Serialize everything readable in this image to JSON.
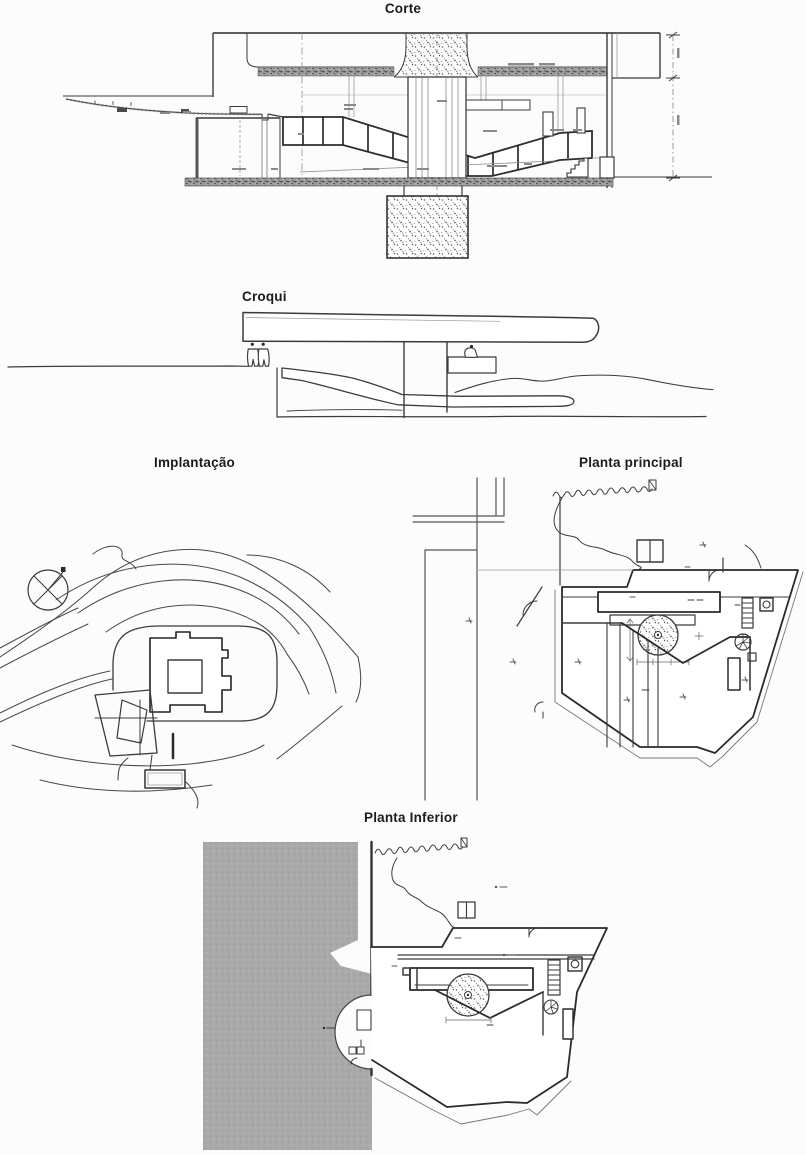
{
  "page": {
    "background": "#fcfcfc",
    "description_palette": {
      "ink": "#3b3b3b",
      "ink_strong": "#2a2a2a",
      "ink_faint": "#9a9a9a",
      "halftone_gray": "#a9a9a9",
      "concrete_stipple": "#606060"
    }
  },
  "figures": {
    "corte": {
      "title": "Corte"
    },
    "croqui": {
      "title": "Croqui"
    },
    "implantacao": {
      "title": "Implantação"
    },
    "planta_principal": {
      "title": "Planta principal"
    },
    "planta_inferior": {
      "title": "Planta Inferior"
    }
  }
}
